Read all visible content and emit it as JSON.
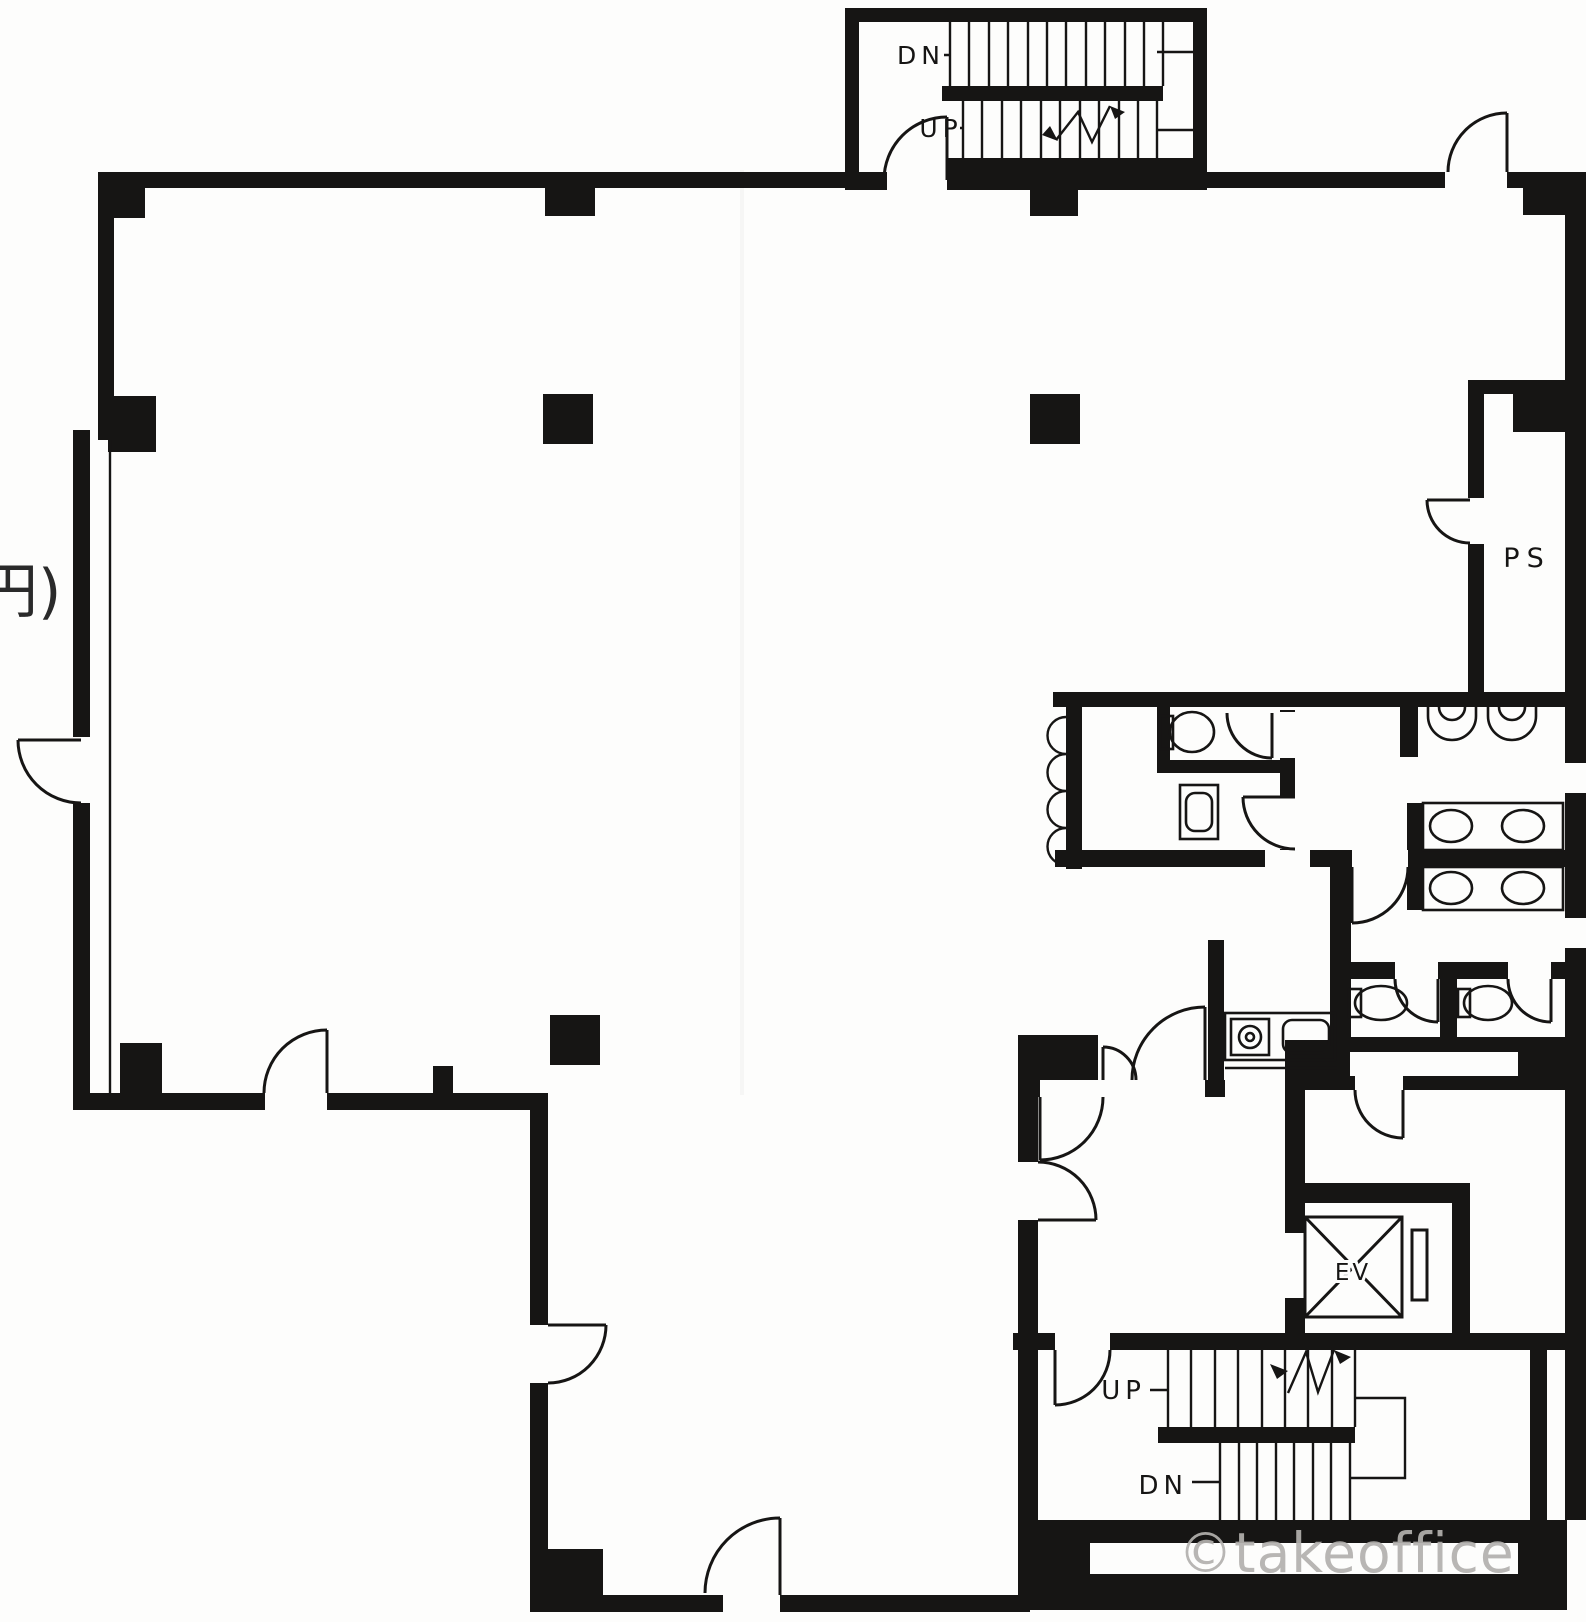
{
  "colors": {
    "paper": "#fdfdfc",
    "ink": "#161514",
    "wm": "#b3b1ae",
    "fragment": "#2a2a2a"
  },
  "plan": {
    "type": "architectural-floor-plan",
    "labels": {
      "upper_stair_dn": "DN",
      "upper_stair_up": "UP",
      "lower_stair_up": "UP",
      "lower_stair_dn": "DN",
      "pipe_shaft": "PS",
      "elevator": "EV",
      "left_edge_fragment": "円)",
      "watermark": "©takeoffice"
    }
  }
}
